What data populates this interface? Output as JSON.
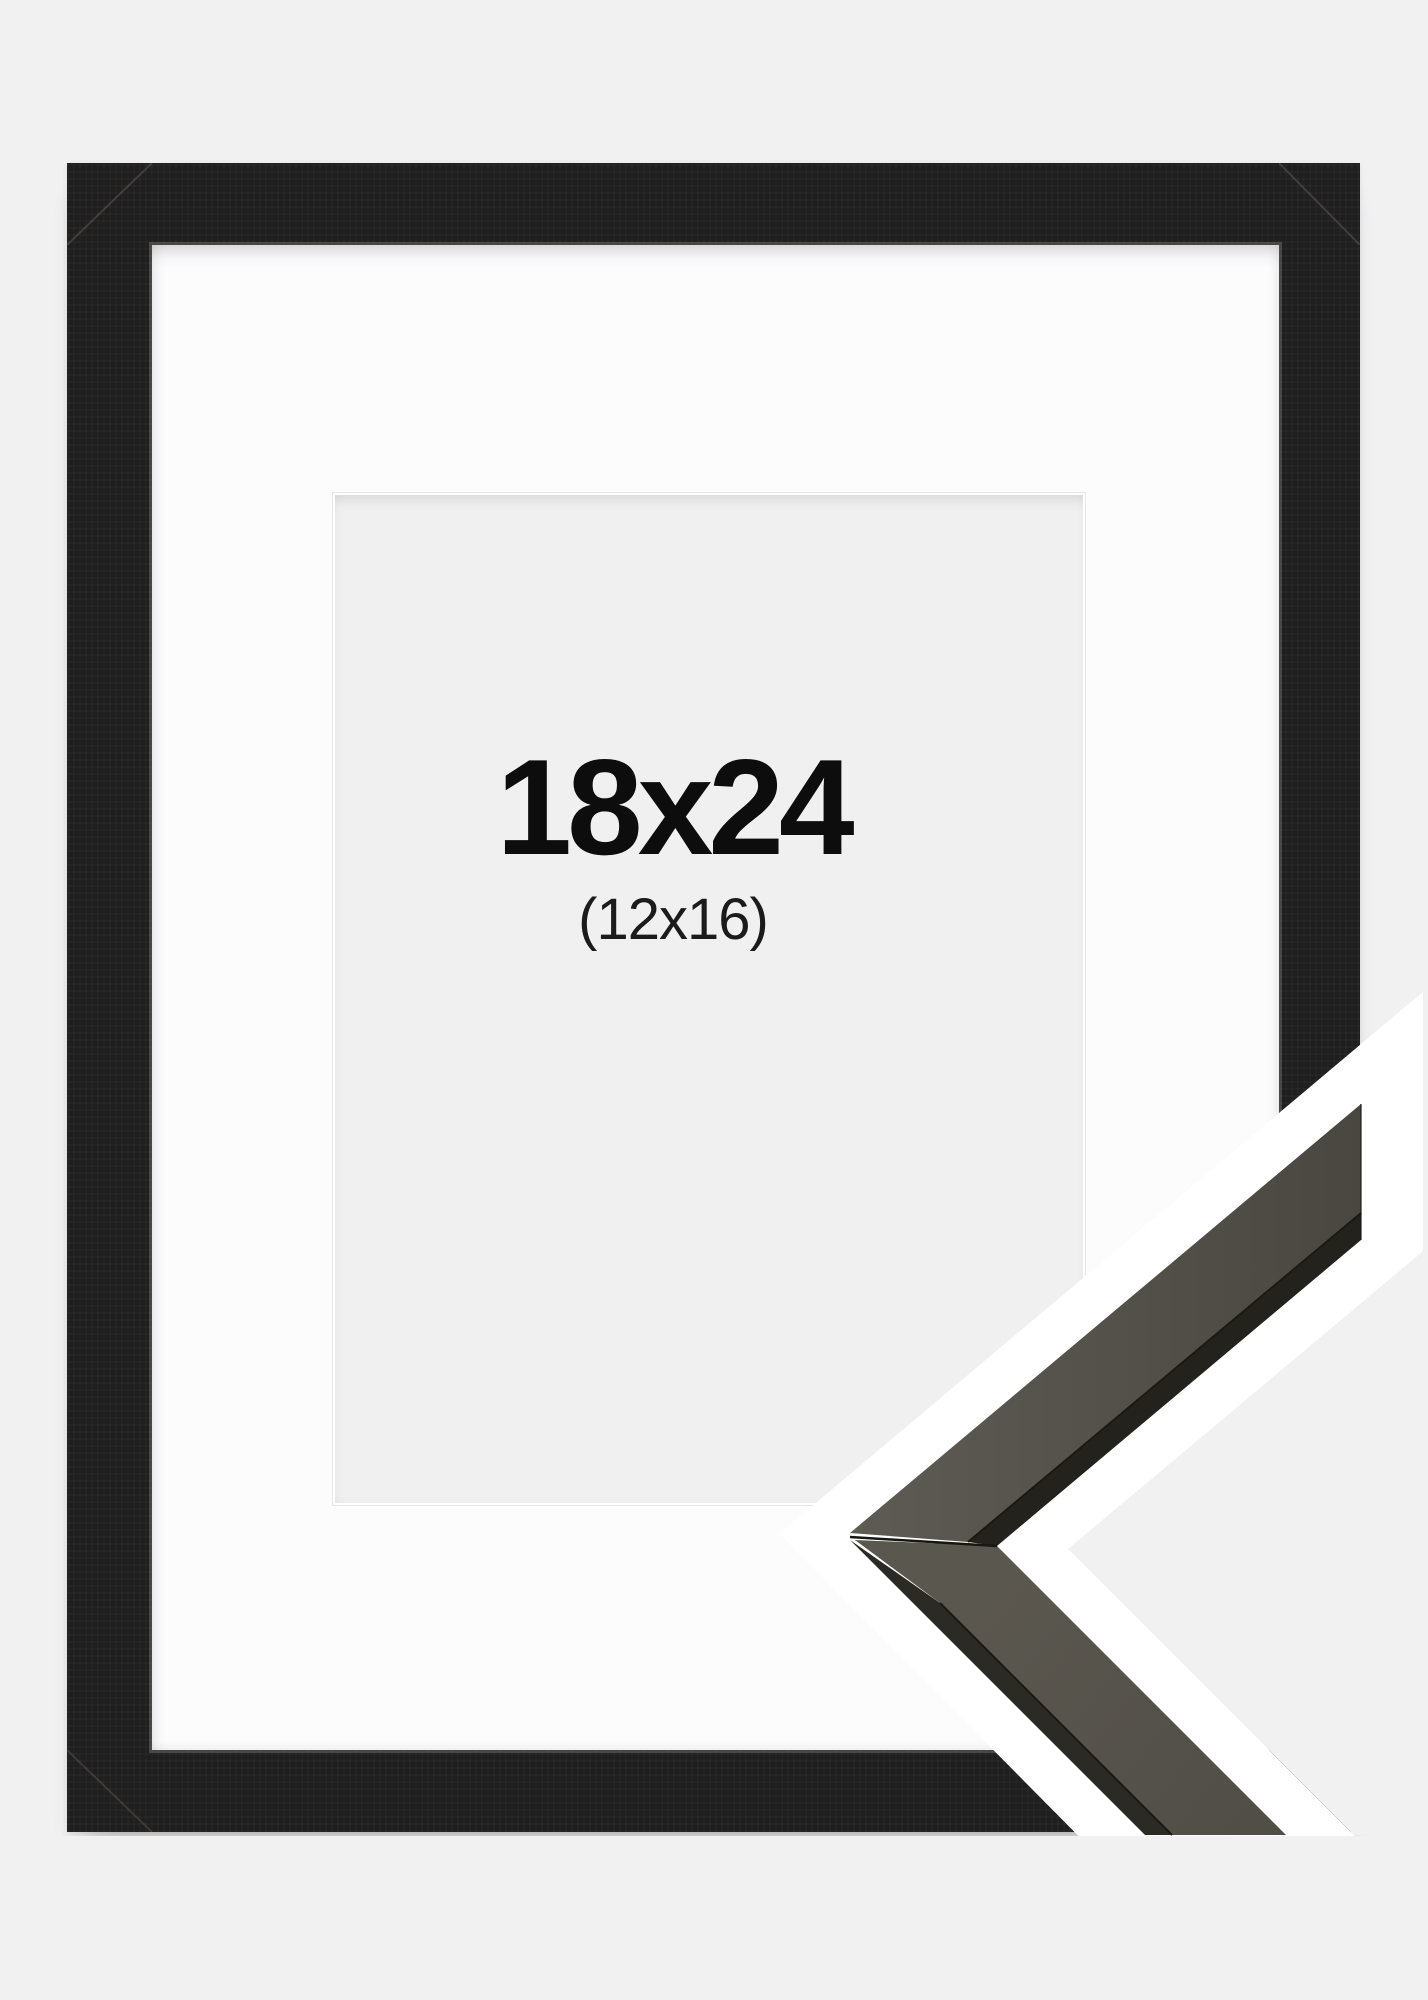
{
  "photo": {
    "size_label": "18x24",
    "inner_size_label": "(12x16)",
    "colors": {
      "page_background": "#f1f1f2",
      "frame_wood": "#201f1f",
      "mat": "#fcfcfd",
      "opening": "#f0f0f1",
      "label_text": "#0d0d0d",
      "sample_outline": "#ffffff",
      "sample_wood_face_light": "#5e5b54",
      "sample_wood_face_dark": "#4a4741",
      "sample_wood_edge_upper": "#23221d",
      "sample_wood_edge_lower": "#2b2a24",
      "sample_seam": "#17160f"
    }
  }
}
